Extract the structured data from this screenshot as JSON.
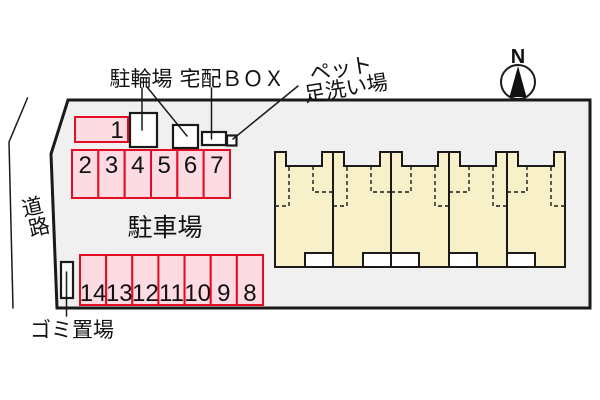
{
  "colors": {
    "site_fill": "#f0f0f0",
    "stall_fill": "#fcdbe3",
    "stall_border": "#e30c22",
    "building_fill": "#f7f0c8",
    "line": "#1a1a1a"
  },
  "labels": {
    "bicycle_parking": "駐輪場",
    "delivery_box": "宅配ＢＯＸ",
    "pet_wash_line1": "ペット",
    "pet_wash_line2": "足洗い場",
    "road_char1": "道",
    "road_char2": "路",
    "car_parking": "駐車場",
    "garbage": "ゴミ置場",
    "north": "N"
  },
  "parking": {
    "stall1": "1",
    "top_row": [
      "2",
      "3",
      "4",
      "5",
      "6",
      "7"
    ],
    "bottom_row": [
      "14",
      "13",
      "12",
      "11",
      "10",
      "9",
      "8"
    ]
  },
  "building": {
    "unit_count": 5
  }
}
